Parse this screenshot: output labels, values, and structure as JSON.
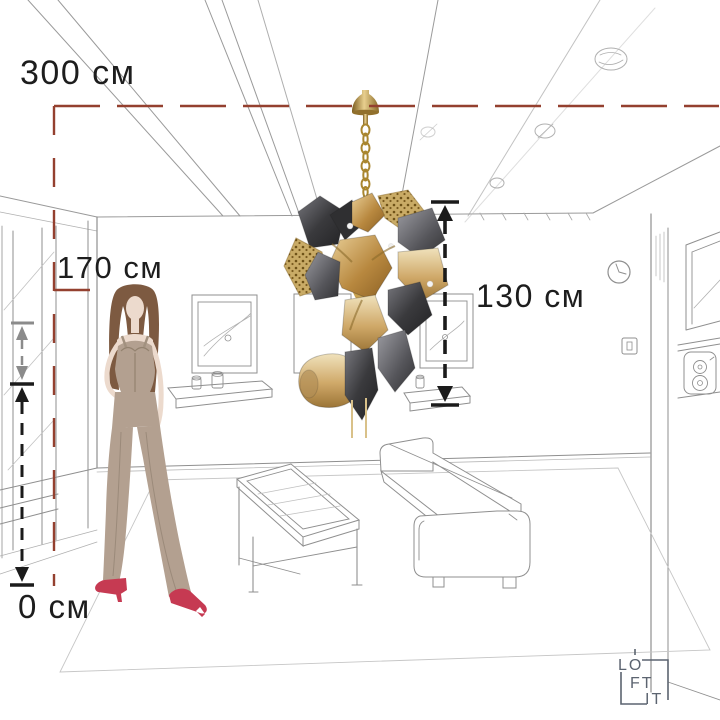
{
  "title": "Chandelier height diagram",
  "measurements": {
    "ceiling": {
      "label": "300 см",
      "value": 300,
      "unit": "см"
    },
    "person": {
      "label": "170 см",
      "value": 170,
      "unit": "см"
    },
    "fixture": {
      "label": "130 см",
      "value": 130,
      "unit": "см"
    },
    "floor": {
      "label": "0 см",
      "value": 0,
      "unit": "см"
    }
  },
  "logo": {
    "line1": "LO",
    "line2": "FT",
    "line3": "IT",
    "name": "LOFT IT"
  },
  "colors": {
    "dimension_red": "#94402f",
    "dimension_black": "#1b1b1b",
    "dimension_gray": "#8b8b8b",
    "sketch_line": "#8f8f8f",
    "sketch_light": "#bdbdbd",
    "logo_gray": "#5c6470",
    "brass": "#a9862f",
    "smoke_glass": "#4a4a4e",
    "amber_glass": "#c79d58",
    "outfit_taupe": "#b3a090",
    "shoe_red": "#c63a52",
    "hair_brown": "#7d5a41",
    "skin": "#ecdacd"
  }
}
